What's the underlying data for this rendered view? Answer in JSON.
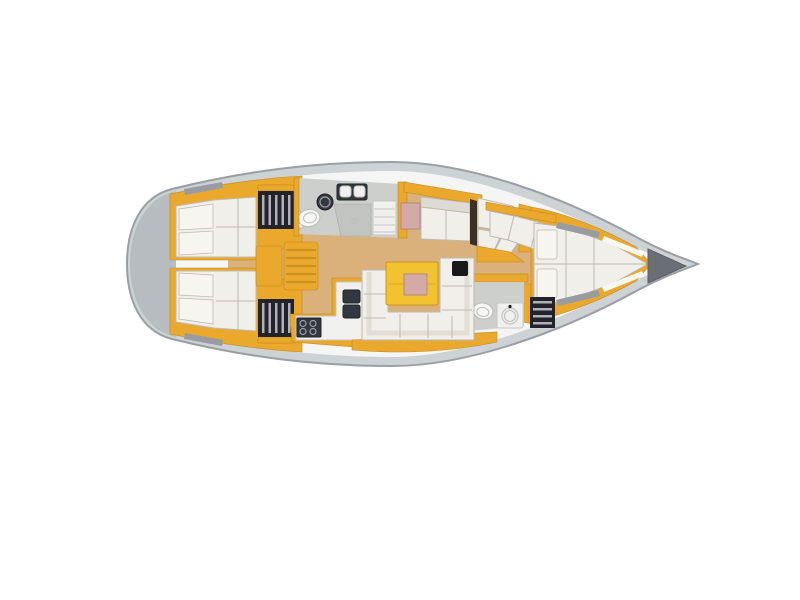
{
  "page": {
    "background": "#ffffff"
  },
  "diagram": {
    "kind": "sailboat-interior-floor-plan",
    "view": "top-down",
    "bow_direction": "right",
    "regions": [
      {
        "id": "stern-swim-platform"
      },
      {
        "id": "aft-cabin-port",
        "features": [
          "double-berth",
          "pillows",
          "wardrobe-locker"
        ]
      },
      {
        "id": "aft-cabin-starboard",
        "features": [
          "double-berth",
          "pillows",
          "wardrobe-locker"
        ]
      },
      {
        "id": "companionway-steps"
      },
      {
        "id": "aft-head",
        "features": [
          "toilet",
          "round-washbasin",
          "twin-bowl-vanity",
          "shower",
          "shelf-unit"
        ]
      },
      {
        "id": "port-settee",
        "features": [
          "bench-cushion",
          "pink-cushion"
        ]
      },
      {
        "id": "nav-station",
        "features": [
          "angled-seat-cushions",
          "chart-desk"
        ]
      },
      {
        "id": "saloon",
        "features": [
          "u-shaped-settee",
          "yellow-table-with-pink-inset",
          "instrument-panel"
        ]
      },
      {
        "id": "galley",
        "features": [
          "l-shaped-counter",
          "twin-sinks",
          "stove-with-four-burners"
        ]
      },
      {
        "id": "forward-head",
        "features": [
          "toilet",
          "washbasin-unit",
          "slatted-locker"
        ]
      },
      {
        "id": "forward-cabin",
        "features": [
          "v-berth",
          "pillows",
          "seat-cushions",
          "side-shelves"
        ]
      },
      {
        "id": "anchor-locker"
      },
      {
        "id": "deck-hatches"
      }
    ]
  },
  "colors": {
    "background": "#ffffff",
    "hull_outline": "#99a0a5",
    "hull_rim": "#cdd2d5",
    "deck": "#f4f5f4",
    "stern_platform": "#b7bcc0",
    "floor_wood": "#dab17a",
    "joinery_yellow": "#eaa82c",
    "joinery_edge": "#c08a1e",
    "table_yellow": "#f2c230",
    "table_edge": "#c9981f",
    "cushion_white": "#f1efe9",
    "cushion_bright": "#f7f5f0",
    "cushion_shade": "#dedbd3",
    "cushion_line": "#bdbab2",
    "upholstery_pink": "#d3aaa5",
    "pink_edge": "#b08a86",
    "locker_dark": "#22242a",
    "locker_stripe": "#c8ccd2",
    "appliance_dark": "#33383e",
    "appliance_line": "#9ba1a8",
    "fixture_white": "#f6f6f4",
    "fixture_line": "#b9bcba",
    "head_floor": "#cdcfcc",
    "shower_gray": "#c2c4c2",
    "shelf_white": "#f0f1ef",
    "shelf_line": "#c6c8c5",
    "nav_dark": "#3a3026",
    "anchor_gray": "#696f74",
    "hatch_gray": "#969ca0",
    "deck_stripe_white": "#fbfbfa"
  }
}
